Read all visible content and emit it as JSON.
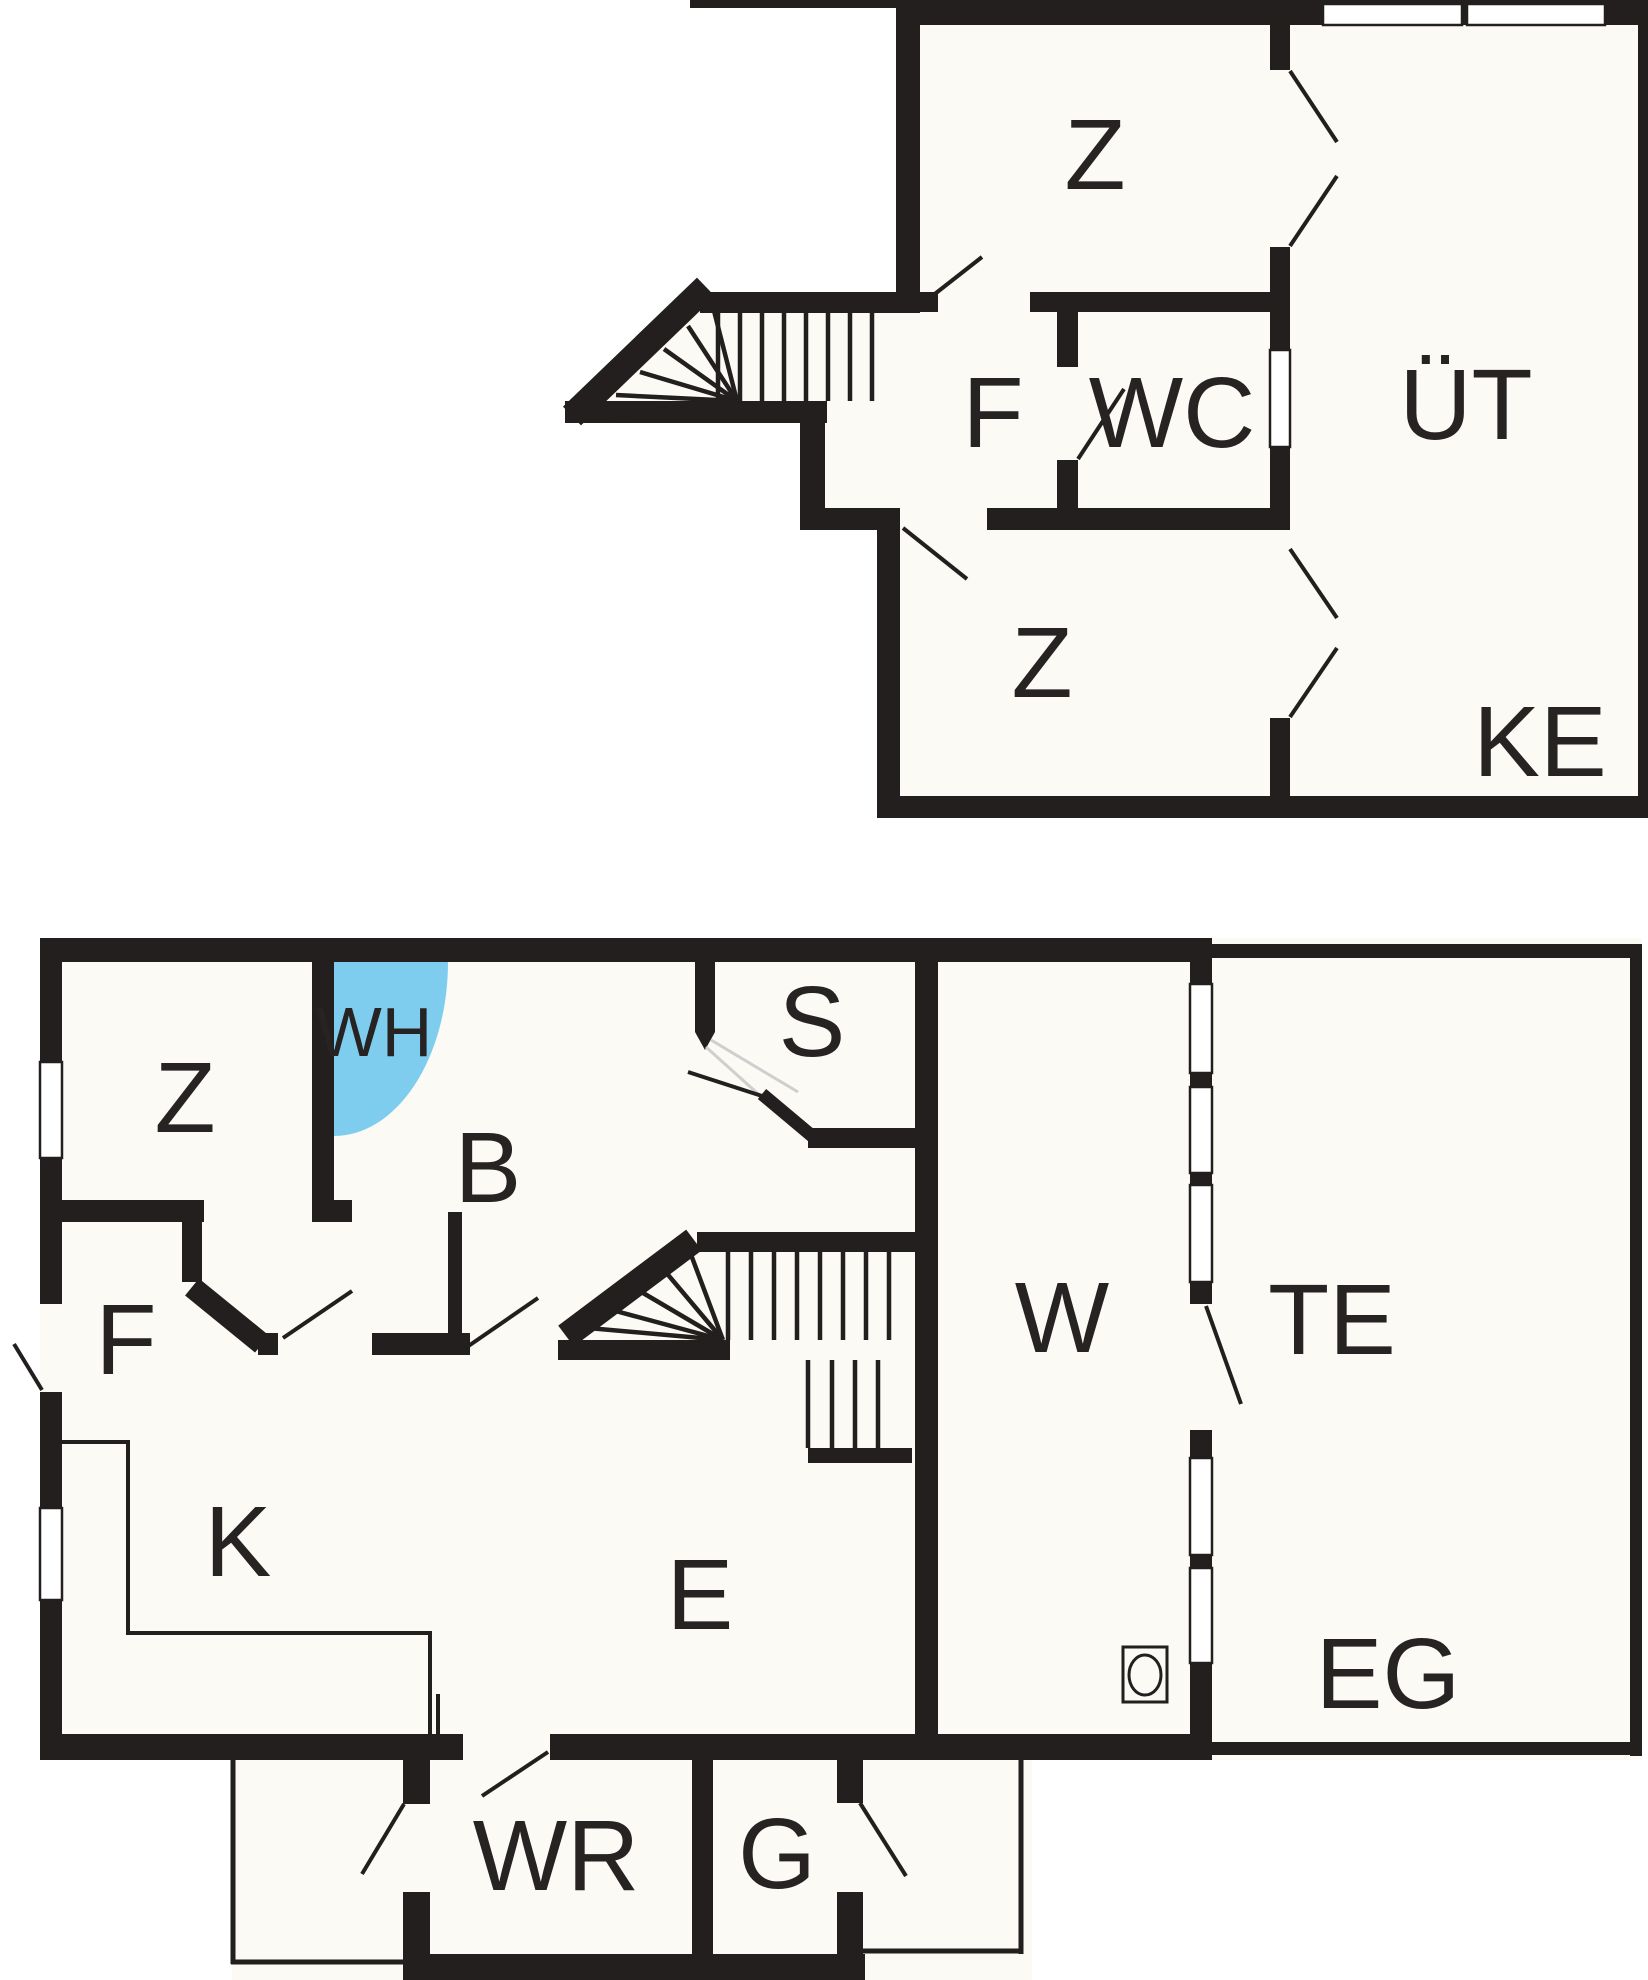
{
  "plan": {
    "title": "two-floor house floor plan",
    "colors": {
      "background": "#FFFFFF",
      "room_fill": "#FBFAF4",
      "wall": "#221F1E",
      "whirlpool": "#7ECDEF",
      "label": "#262322",
      "door_swing_light": "#CFCFCF"
    },
    "symbols": {
      "stove_icon": "square-with-circle",
      "whirlpool_icon": "blue-quarter-circle",
      "stairs_icon": "tread-lines-with-winders"
    },
    "floors": [
      {
        "name": "upper-plan",
        "floor_label": "KE",
        "rooms": [
          {
            "label": "Z"
          },
          {
            "label": "F"
          },
          {
            "label": "WC"
          },
          {
            "label": "ÜT"
          },
          {
            "label": "Z"
          }
        ]
      },
      {
        "name": "lower-plan",
        "floor_label": "EG",
        "rooms": [
          {
            "label": "Z"
          },
          {
            "label": "WH"
          },
          {
            "label": "B"
          },
          {
            "label": "S"
          },
          {
            "label": "W"
          },
          {
            "label": "TE"
          },
          {
            "label": "F"
          },
          {
            "label": "K"
          },
          {
            "label": "E"
          },
          {
            "label": "WR"
          },
          {
            "label": "G"
          }
        ]
      }
    ]
  }
}
